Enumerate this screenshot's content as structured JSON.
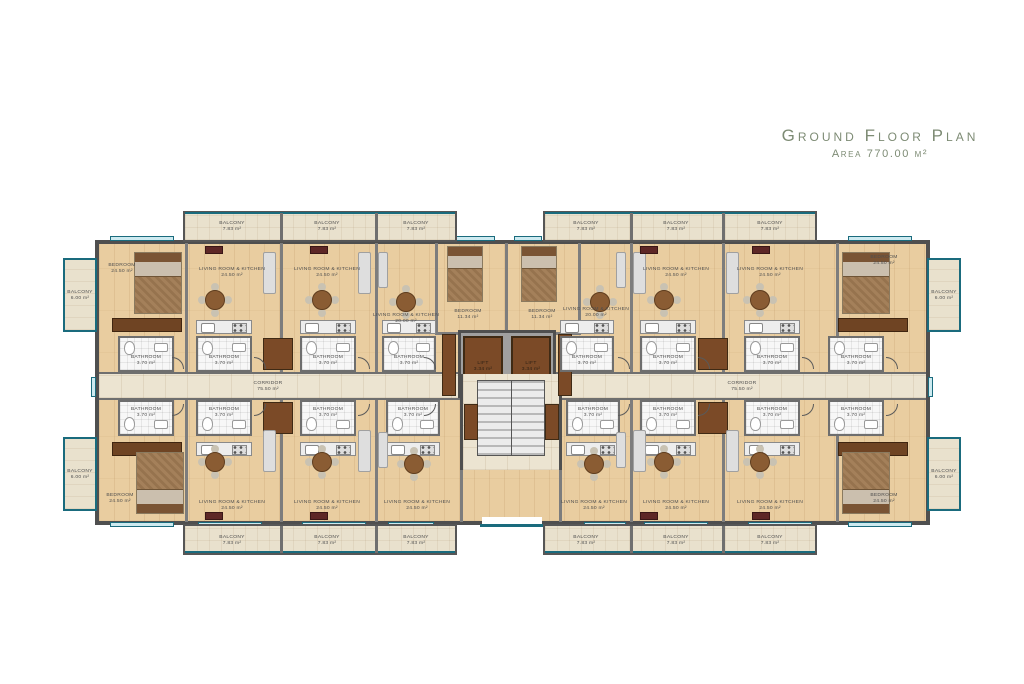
{
  "title": {
    "heading": "Ground Floor Plan",
    "subtitle": "Area 770.00 m²"
  },
  "labels": {
    "balcony_top": {
      "name": "BALCONY",
      "area": "7.83 m²"
    },
    "balcony_side": {
      "name": "BALCONY",
      "area": "6.00 m²"
    },
    "bedroom_large": {
      "name": "BEDROOM",
      "area": "24.50 m²"
    },
    "bedroom_small": {
      "name": "BEDROOM",
      "area": "11.34 m²"
    },
    "living_large": {
      "name": "LIVING ROOM & KITCHEN",
      "area": "24.50 m²"
    },
    "living_small": {
      "name": "LIVING ROOM & KITCHEN",
      "area": "20.00 m²"
    },
    "bathroom": {
      "name": "BATHROOM",
      "area": "3.70 m²"
    },
    "lift": {
      "name": "LIFT",
      "area": "3.34 m²"
    },
    "corridor": {
      "name": "CORRIDOR",
      "area": "75.50 m²"
    }
  },
  "colors": {
    "accent_teal": "#1a6b7d",
    "wall_gray": "#4f4f4f",
    "wood_floor": "#e9cda0",
    "stone_floor": "#ece4d1",
    "furniture_brown": "#7b4a27",
    "title_green": "#7d8b74"
  }
}
